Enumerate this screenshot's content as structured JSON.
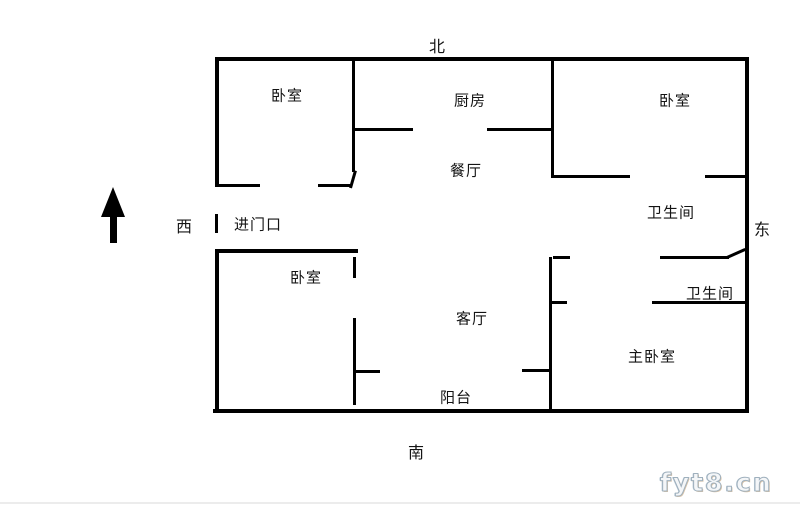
{
  "compass": {
    "north": "北",
    "south": "南",
    "west": "西",
    "east": "东"
  },
  "labels": {
    "entrance": "进门口",
    "bedroom_top_left": "卧室",
    "bedroom_top_right": "卧室",
    "bedroom_bottom_left": "卧室",
    "master_bedroom": "主卧室",
    "kitchen": "厨房",
    "dining_room": "餐厅",
    "living_room": "客厅",
    "balcony": "阳台",
    "bathroom_upper": "卫生间",
    "bathroom_lower": "卫生间"
  },
  "watermark": "fyt8.cn",
  "colors": {
    "wall": "#000000",
    "text": "#141414",
    "watermark_stroke": "#9fb0bd"
  }
}
